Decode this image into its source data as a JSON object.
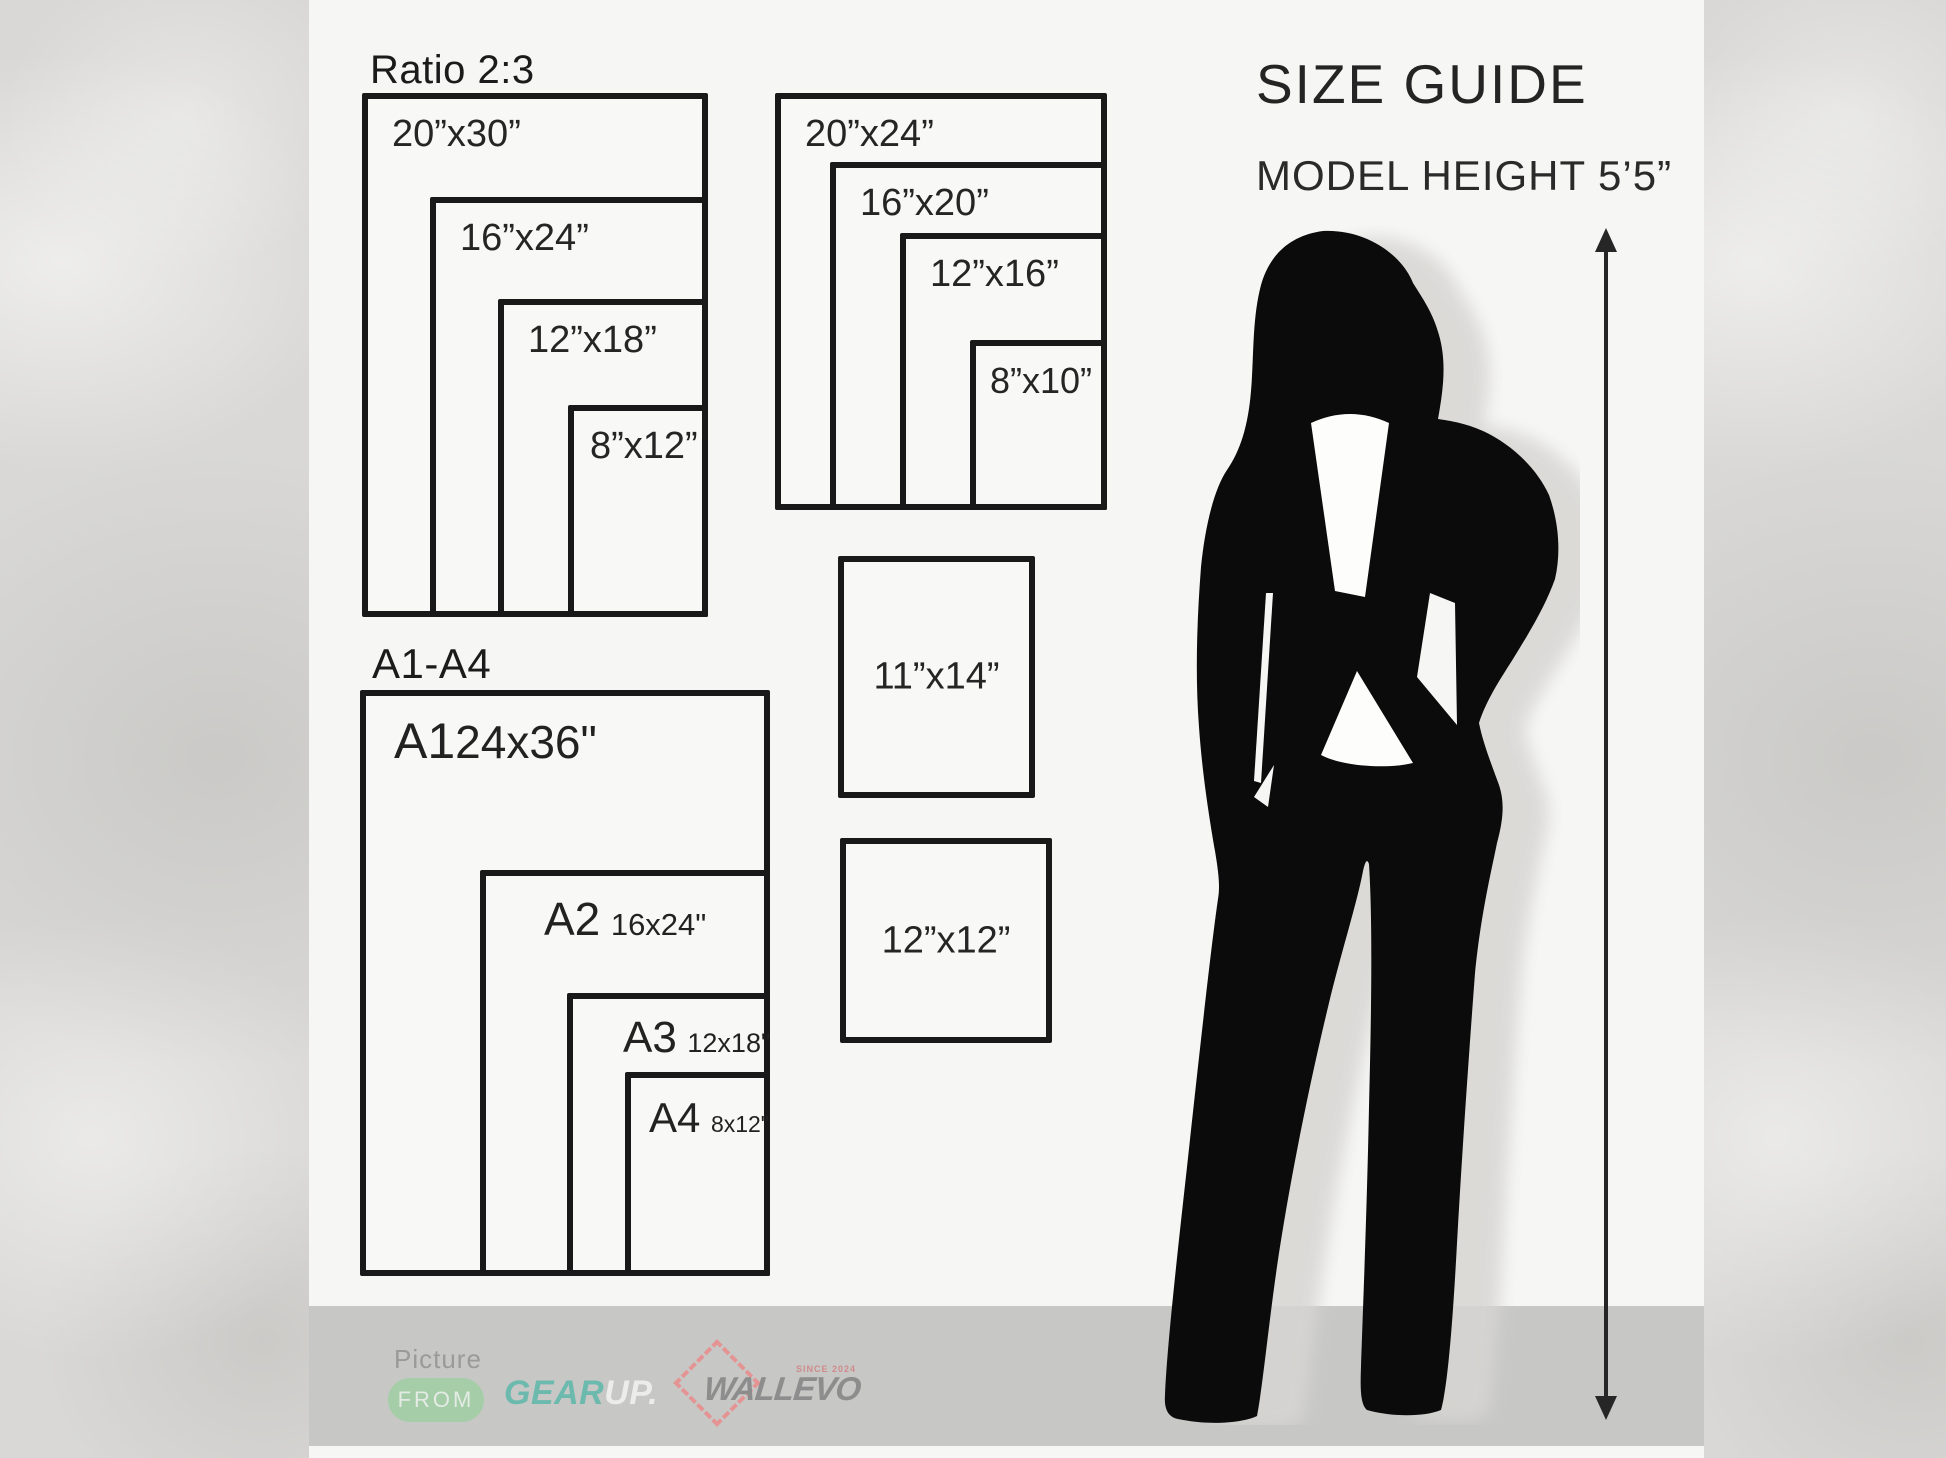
{
  "header": {
    "title": "SIZE GUIDE",
    "model_height": "MODEL HEIGHT 5’5”"
  },
  "groups": {
    "ratio": {
      "title": "Ratio 2:3",
      "sizes": [
        "20”x30”",
        "16”x24”",
        "12”x18”",
        "8”x12”"
      ]
    },
    "standard": {
      "sizes": [
        "20”x24”",
        "16”x20”",
        "12”x16”",
        "8”x10”"
      ]
    },
    "aseries": {
      "title": "A1-A4",
      "items": [
        {
          "code": "A1",
          "dim": "24x36\""
        },
        {
          "code": "A2",
          "dim": "16x24\""
        },
        {
          "code": "A3",
          "dim": "12x18\""
        },
        {
          "code": "A4",
          "dim": "8x12\""
        }
      ]
    }
  },
  "singles": [
    "11”x14”",
    "12”x12”"
  ],
  "footer": {
    "picture_label": "Picture",
    "from_label": "FROM",
    "gear": "GEAR",
    "up": "UP.",
    "brand": "WALLEVO",
    "since": "SINCE 2024"
  },
  "colors": {
    "ink": "#191919",
    "panel": "#f6f6f4",
    "texture_gray": "#d9d8d6",
    "band_gray": "#c7c7c6",
    "pill_green": "#a5cda8",
    "gear_teal": "#6cb9ad",
    "brand_gray": "#8d8d8d",
    "diamond_red": "#e59494"
  }
}
